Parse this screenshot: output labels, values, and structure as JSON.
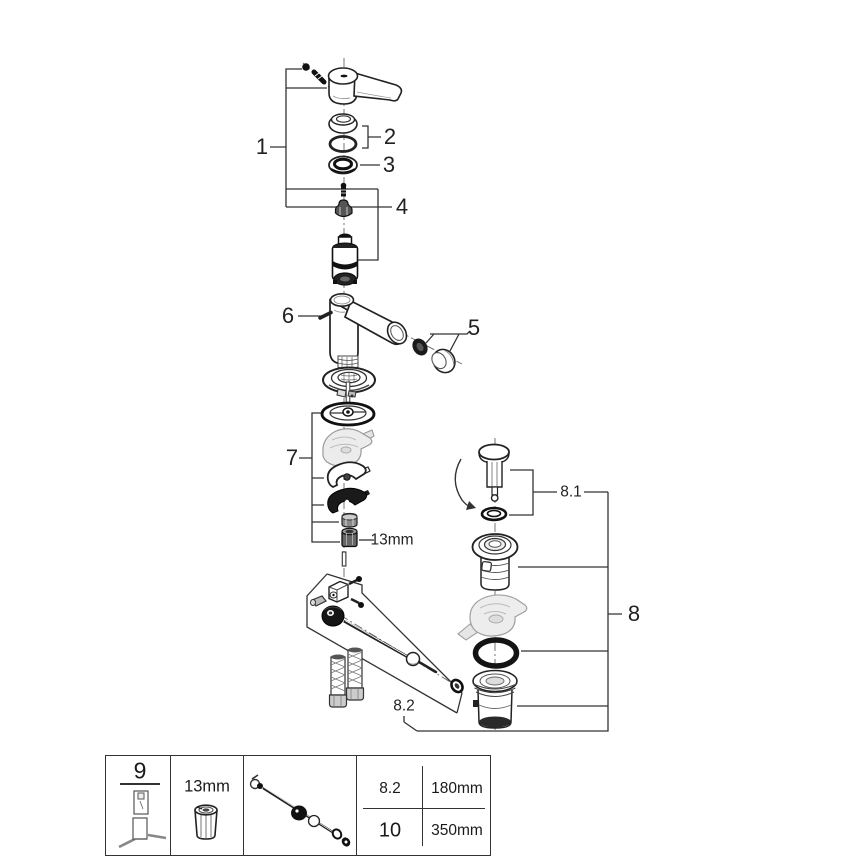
{
  "labels": {
    "part1": "1",
    "part2": "2",
    "part3": "3",
    "part4": "4",
    "part5": "5",
    "part6": "6",
    "part7": "7",
    "part8": "8",
    "part8_1": "8.1",
    "part8_2": "8.2",
    "wrench_size": "13mm"
  },
  "table": {
    "tool_ref": "9",
    "socket_size": "13mm",
    "specs": [
      {
        "ref": "8.2",
        "length": "180mm"
      },
      {
        "ref": "10",
        "length": "350mm"
      }
    ]
  },
  "colors": {
    "line": "#2a2a2a",
    "black_fill": "#111111",
    "gray": "#8a8a8a",
    "light_gray": "#ececec",
    "background": "#ffffff"
  }
}
